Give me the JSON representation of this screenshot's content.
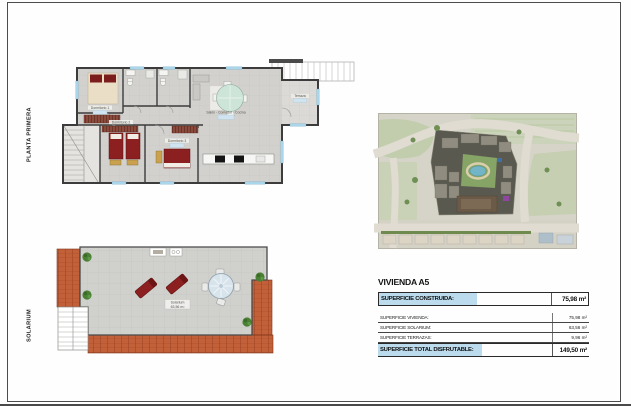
{
  "page_labels": {
    "floor": "PLANTA PRIMERA",
    "solarium": "SOLARIUM"
  },
  "floor_plan": {
    "rooms": {
      "dormitorio1": "Dormitorio 1",
      "dormitorio2": "Dormitorio 2",
      "dormitorio3": "Dormitorio 3",
      "salon": "Salón - Comedor - Cocina",
      "terraza": "Terraza"
    }
  },
  "solarium_plan": {
    "label": "Solarium",
    "area": "63,56 m²"
  },
  "info": {
    "title": "VIVIENDA A5",
    "construida_label": "SUPERFICIE CONSTRUIDA:",
    "construida_value": "75,98 m²",
    "rows": [
      {
        "label": "SUPERFICIE VIVIENDA:",
        "value": "75,98 m²"
      },
      {
        "label": "SUPERFICIE SOLARIUM:",
        "value": "63,56 m²"
      },
      {
        "label": "SUPERFICIE TERRAZAS:",
        "value": "9,96 m²"
      }
    ],
    "total_label": "SUPERFICIE TOTAL DISFRUTABLE:",
    "total_value": "149,50 m²"
  },
  "colors": {
    "highlight_blue": "#bcdcee",
    "wall": "#3c3c3c",
    "floor_tile": "#d2d1ce",
    "roof_terracotta": "#c2603a",
    "bed_red": "#8c1f1f",
    "window_blue": "#a9d6ea",
    "map_green": "#c6cfb2",
    "pool_blue": "#72b5c6"
  }
}
